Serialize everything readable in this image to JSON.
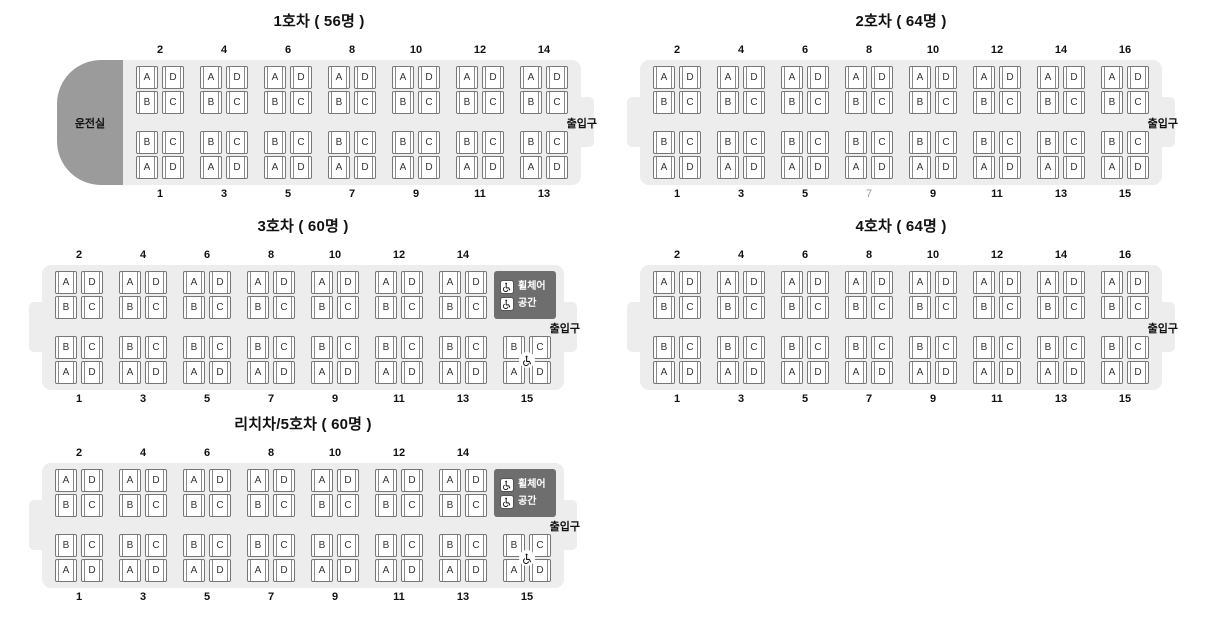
{
  "labels": {
    "cab": "운전실",
    "door": "출입구",
    "wheelchair": [
      "휠체어",
      "공간"
    ]
  },
  "seat_letters": {
    "upper": [
      [
        "A",
        "D"
      ],
      [
        "B",
        "C"
      ]
    ],
    "lower": [
      [
        "B",
        "C"
      ],
      [
        "A",
        "D"
      ]
    ]
  },
  "colors": {
    "car_body": "#ededed",
    "driver_cab": "#9b9b9b",
    "wheelchair_box": "#6e6e6e",
    "seat_border": "#777777",
    "muted_number": "#9a9a9a"
  },
  "cars": [
    {
      "id": "car-1",
      "title": "1호차 ( 56명 )",
      "top_cols": [
        2,
        4,
        6,
        8,
        10,
        12,
        14
      ],
      "bottom_cols": [
        1,
        3,
        5,
        7,
        9,
        11,
        13
      ],
      "muted_bottom": [],
      "has_cab": true,
      "left_door": false,
      "wheelchair_space": false,
      "wheelchair_seat": false,
      "pos": {
        "left": 57,
        "top": 10
      }
    },
    {
      "id": "car-2",
      "title": "2호차 ( 64명 )",
      "top_cols": [
        2,
        4,
        6,
        8,
        10,
        12,
        14,
        16
      ],
      "bottom_cols": [
        1,
        3,
        5,
        7,
        9,
        11,
        13,
        15
      ],
      "muted_bottom": [
        7
      ],
      "has_cab": false,
      "left_door": true,
      "wheelchair_space": false,
      "wheelchair_seat": false,
      "pos": {
        "left": 640,
        "top": 10
      }
    },
    {
      "id": "car-3",
      "title": "3호차 ( 60명 )",
      "top_cols": [
        2,
        4,
        6,
        8,
        10,
        12,
        14
      ],
      "bottom_cols": [
        1,
        3,
        5,
        7,
        9,
        11,
        13,
        15
      ],
      "muted_bottom": [],
      "has_cab": false,
      "left_door": true,
      "wheelchair_space": true,
      "wheelchair_seat": true,
      "pos": {
        "left": 42,
        "top": 215
      }
    },
    {
      "id": "car-4",
      "title": "4호차 ( 64명 )",
      "top_cols": [
        2,
        4,
        6,
        8,
        10,
        12,
        14,
        16
      ],
      "bottom_cols": [
        1,
        3,
        5,
        7,
        9,
        11,
        13,
        15
      ],
      "muted_bottom": [],
      "has_cab": false,
      "left_door": true,
      "wheelchair_space": false,
      "wheelchair_seat": false,
      "pos": {
        "left": 640,
        "top": 215
      }
    },
    {
      "id": "car-5",
      "title": "리치차/5호차 ( 60명 )",
      "top_cols": [
        2,
        4,
        6,
        8,
        10,
        12,
        14
      ],
      "bottom_cols": [
        1,
        3,
        5,
        7,
        9,
        11,
        13,
        15
      ],
      "muted_bottom": [],
      "has_cab": false,
      "left_door": true,
      "wheelchair_space": true,
      "wheelchair_seat": true,
      "pos": {
        "left": 42,
        "top": 413
      }
    }
  ]
}
